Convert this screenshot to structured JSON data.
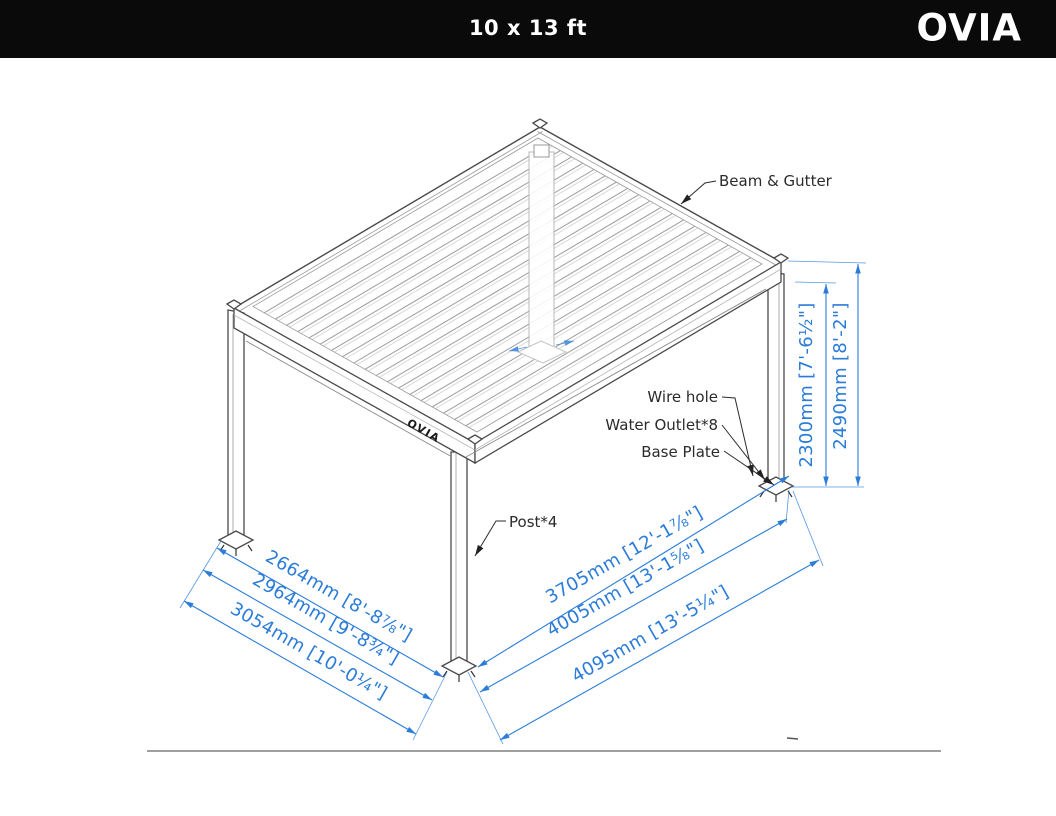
{
  "header": {
    "title": "10 x 13 ft",
    "brand": "OVIA"
  },
  "diagram": {
    "beam_brand": "OVIA",
    "labels": {
      "beam_gutter": "Beam & Gutter",
      "wire_hole": "Wire hole",
      "water_outlet": "Water Outlet*8",
      "base_plate": "Base Plate",
      "post": "Post*4"
    },
    "dims": {
      "depth": [
        "2664mm [8'-8⅞\"]",
        "2964mm [9'-8¾\"]",
        "3054mm [10'-0¼\"]"
      ],
      "length": [
        "3705mm [12'-1⅞\"]",
        "4005mm [13'-1⅝\"]",
        "4095mm [13'-5¼\"]"
      ],
      "height": [
        "2300mm [7'-6½\"]",
        "2490mm [8'-2\"]"
      ]
    },
    "colors": {
      "dimension_blue": "#2b7cd9",
      "line_dark": "#4a4a4a",
      "header_bg": "#0a0a0a"
    }
  }
}
